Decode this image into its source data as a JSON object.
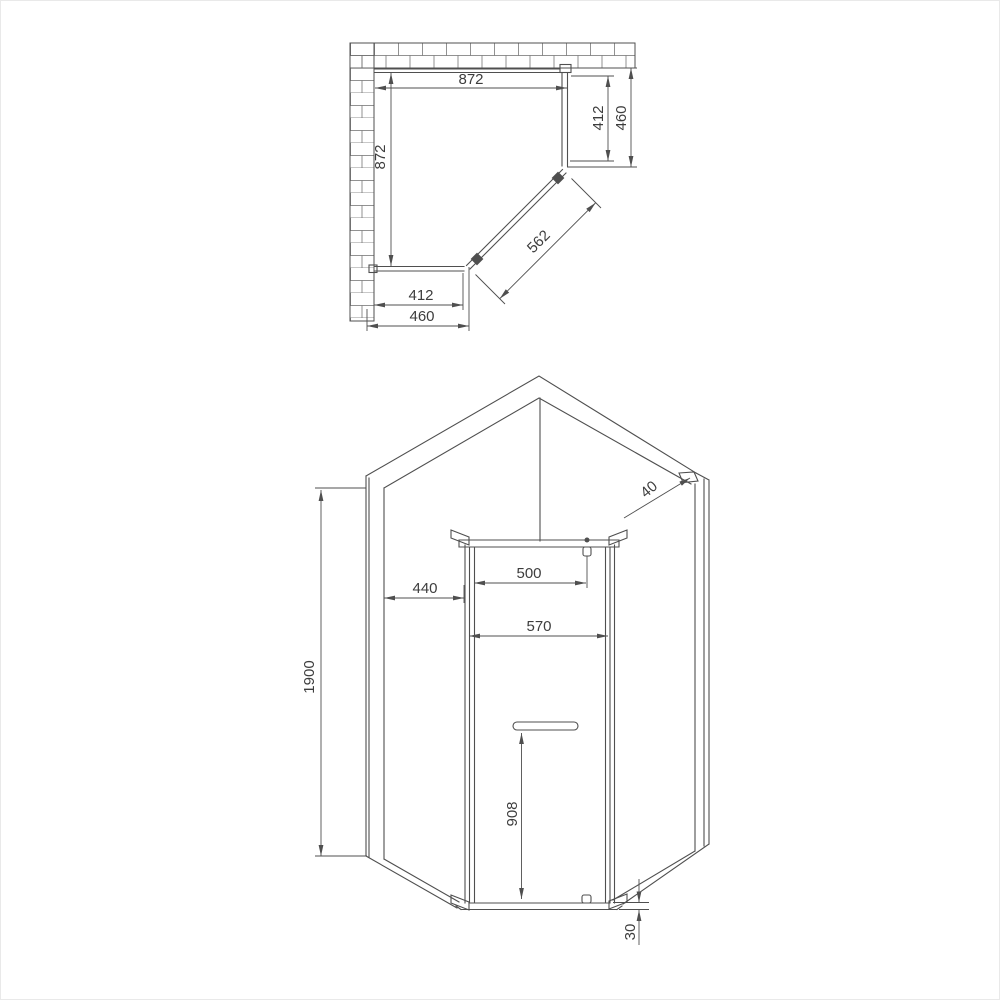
{
  "drawing": {
    "plan": {
      "dims": {
        "top_width": "872",
        "left_depth": "872",
        "right_panel_inner": "412",
        "right_panel_outer": "460",
        "door_diagonal": "562",
        "bottom_panel_inner": "412",
        "bottom_panel_outer": "460"
      }
    },
    "elevation": {
      "dims": {
        "profile_width": "40",
        "handle_offset": "500",
        "side_panel_width": "440",
        "door_width": "570",
        "total_height": "1900",
        "handle_height": "908",
        "tray_height": "30"
      }
    }
  },
  "colors": {
    "line": "#4f4f4f",
    "text": "#3d3d3d",
    "background": "#ffffff"
  }
}
